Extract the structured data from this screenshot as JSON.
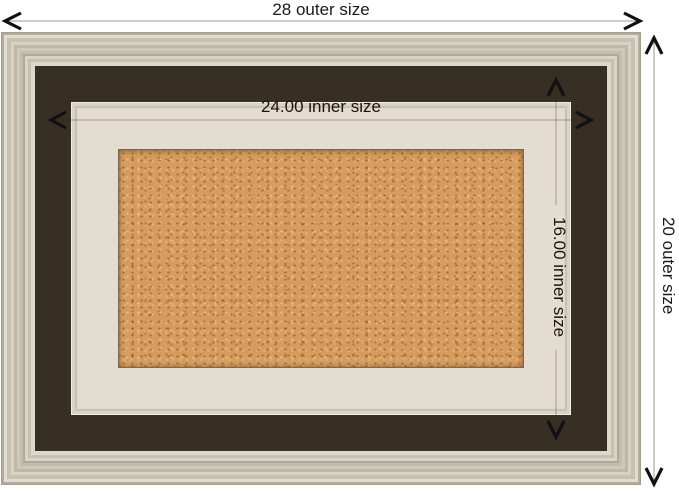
{
  "diagram": {
    "labels": {
      "outer_width": "28 outer size",
      "outer_height": "20 outer size",
      "inner_width": "24.00 inner size",
      "inner_height": "16.00 inner size"
    },
    "colors": {
      "background": "#ffffff",
      "molding_base": "#c9c3b3",
      "accent_line": "#382f24",
      "lip": "#e2ddd0",
      "cork": "#d69b5e",
      "outer_dimension_line": "#9a9a9a",
      "inner_dimension_line": "#3a2512",
      "arrow": "#111111",
      "text": "#1a1a1a"
    }
  }
}
